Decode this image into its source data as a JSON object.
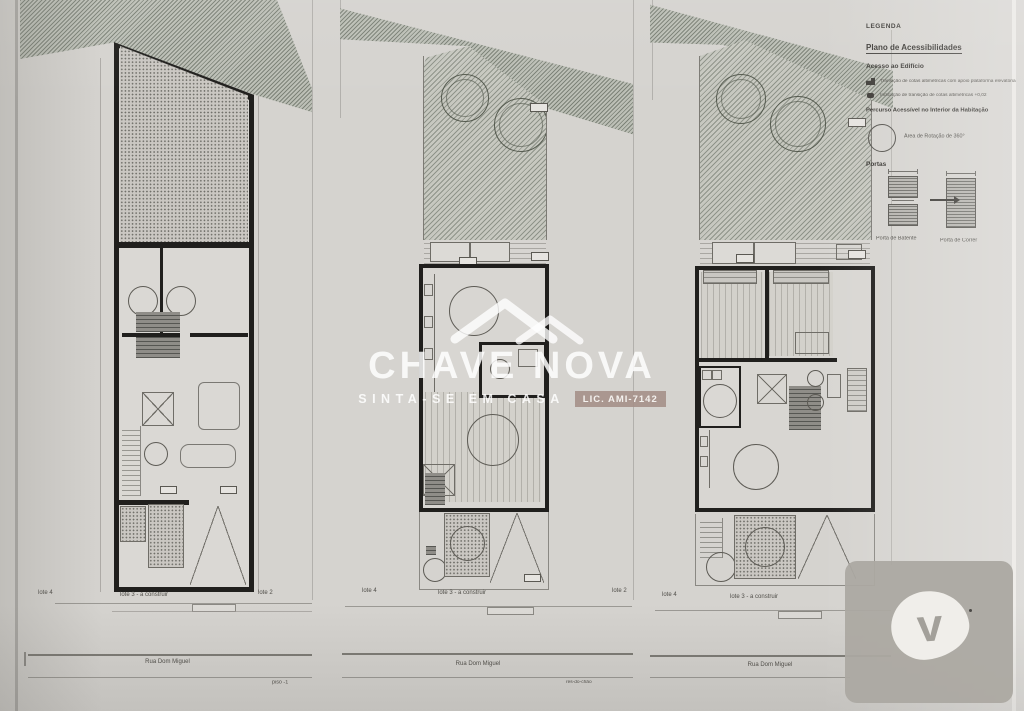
{
  "sheet": {
    "plans": [
      {
        "name": "basement-plan",
        "floor_label": "piso -1",
        "street_label": "Rua Dom Miguel",
        "lots": {
          "left": "lote 4",
          "center": "lote 3 - a construir",
          "right": "lote 2"
        }
      },
      {
        "name": "ground-floor-plan",
        "floor_label": "rés-do-chão",
        "street_label": "Rua Dom Miguel",
        "lots": {
          "left": "lote 4",
          "center": "lote 3 - a construir",
          "right": "lote 2"
        }
      },
      {
        "name": "first-floor-plan",
        "floor_label": "",
        "street_label": "Rua Dom Miguel",
        "lots": {
          "left": "lote 4",
          "center": "lote 3 - a construir",
          "right": ""
        }
      }
    ],
    "legend": {
      "title": "LEGENDA",
      "plan_title": "Plano de Acessibilidades",
      "access_section": "Acesso ao Edifício",
      "access_items": [
        "Transição de cotas altimétricas com apoio plataforma elevatória",
        "Indicação de transição de cotas altimétricas +0,02"
      ],
      "route_section": "Percurso Acessível no Interior da Habitação",
      "rotation_label": "Área de Rotação de 360°",
      "doors_title": "Portas",
      "door_hinged_label": "Porta de Batente",
      "door_sliding_label": "Porta de Correr"
    }
  },
  "watermark": {
    "brand": "CHAVE NOVA",
    "tagline": "SINTA-SE EM CASA",
    "license": "LIC. AMI-7142"
  },
  "corner_logo": {
    "letter": "v"
  },
  "colors": {
    "paper": "#d5d3cf",
    "wall": "#201f1d",
    "license_badge": "#a48e88",
    "overlay_grey": "#abA8a2",
    "watermark": "#ffffff"
  }
}
